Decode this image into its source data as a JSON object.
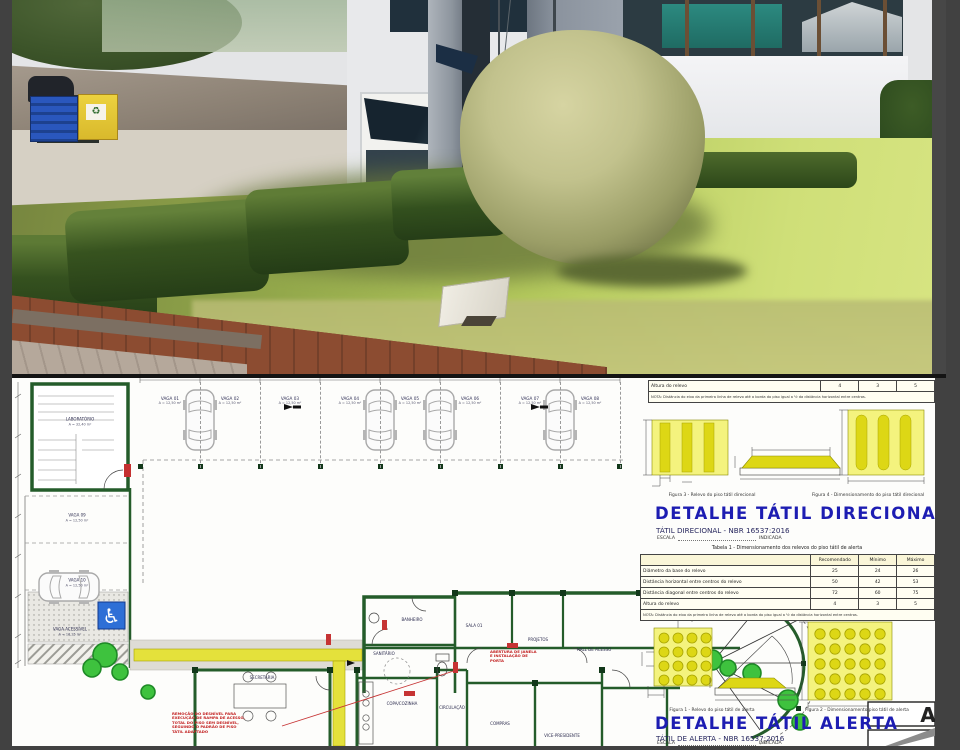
{
  "page": {
    "kind": "Prancha de acessibilidade: foto do local (acima) e planta baixa com detalhes de piso tátil (abaixo)",
    "accent_blue": "#1d1db2",
    "tactile_yellow": "#e4e13b",
    "wall_green": "#245c2a",
    "note_red": "#c22020"
  },
  "detail_direcional": {
    "title": "DETALHE TÁTIL DIRECIONAL",
    "subtitle": "TÁTIL DIRECIONAL - NBR 16537:2016",
    "escala_label": "ESCALA",
    "escala_value": "INDICADA",
    "figura3_caption": "Figura 3 - Relevo do piso tátil direcional",
    "figura4_caption": "Figura 4 - Dimensionamento do piso tátil direcional"
  },
  "tabela_direcional_parcial": {
    "row": [
      "Altura do relevo",
      "4",
      "3",
      "5"
    ],
    "nota": "NOTA: Distância do eixo da primeira linha de relevo até a borda do piso igual a ½ da distância horizontal entre centros."
  },
  "tabela_alerta": {
    "caption": "Tabela 1 - Dimensionamento dos relevos do piso tátil de alerta",
    "headers": [
      "",
      "Recomendado",
      "Mínimo",
      "Máximo"
    ],
    "rows": [
      [
        "Diâmetro da base do relevo",
        "25",
        "24",
        "26"
      ],
      [
        "Distância horizontal entre centros do relevo",
        "50",
        "42",
        "53"
      ],
      [
        "Distância diagonal entre centros do relevo",
        "72",
        "60",
        "75"
      ],
      [
        "Altura do relevo",
        "4",
        "3",
        "5"
      ]
    ],
    "nota": "NOTA: Distância do eixo da primeira linha de relevo até a borda do piso igual a ½ da distância horizontal entre centros."
  },
  "detail_alerta": {
    "title": "DETALHE TÁTIL ALERTA",
    "subtitle": "TÁTIL DE ALERTA - NBR 16537:2016",
    "escala_label": "ESCALA",
    "escala_value": "INDICADA",
    "figura1_caption": "Figura 1 - Relevo do piso tátil de alerta",
    "figura2_caption": "Figura 2 - Dimensionamento piso tátil de alerta"
  },
  "title_block": {
    "sheet_letter": "A"
  },
  "floor_plan": {
    "parking": [
      {
        "label": "VAGA 01",
        "area": "A = 12,50 m²"
      },
      {
        "label": "VAGA 02",
        "area": "A = 12,50 m²"
      },
      {
        "label": "VAGA 03",
        "area": "A = 12,50 m²"
      },
      {
        "label": "VAGA 04",
        "area": "A = 12,50 m²"
      },
      {
        "label": "VAGA 05",
        "area": "A = 12,50 m²"
      },
      {
        "label": "VAGA 06",
        "area": "A = 12,50 m²"
      },
      {
        "label": "VAGA 07",
        "area": "A = 12,50 m²"
      },
      {
        "label": "VAGA 08",
        "area": "A = 12,50 m²"
      }
    ],
    "left_parking": [
      {
        "label": "VAGA 09",
        "area": "A = 12,50 m²"
      },
      {
        "label": "VAGA 10",
        "area": "A = 12,50 m²"
      },
      {
        "label": "VAGA ACESSÍVEL",
        "area": "A = 16,25 m²"
      }
    ],
    "garage_label": "LABORATÓRIO",
    "garage_area": "A = 32,40 m²",
    "rooms": {
      "banheiro": "BANHEIRO",
      "sanitario": "SANITÁRIO",
      "sala01": "SALA 01",
      "projetos": "PROJETOS",
      "hall": "HALL DE ACESSO",
      "secretaria": "SECRETARIA",
      "copa": "COPA/COZINHA",
      "circulacao": "CIRCULAÇÃO",
      "compras": "COMPRAS",
      "vice": "VICE-PRESIDENTE"
    },
    "red_note_1": [
      "ABERTURA DE JANELA",
      "E INSTALAÇÃO DE",
      "PORTA"
    ],
    "red_note_2": [
      "REMOÇÃO DO DESNÍVEL PARA",
      "EXECUÇÃO DE RAMPA DE ACESSO,",
      "TOTAL DO PISO SEM DESNÍVEL,",
      "SEGUINDO O PADRÃO DE PISO",
      "TÁTIL ADAPTADO"
    ],
    "wheelchair_symbol": "♿"
  }
}
